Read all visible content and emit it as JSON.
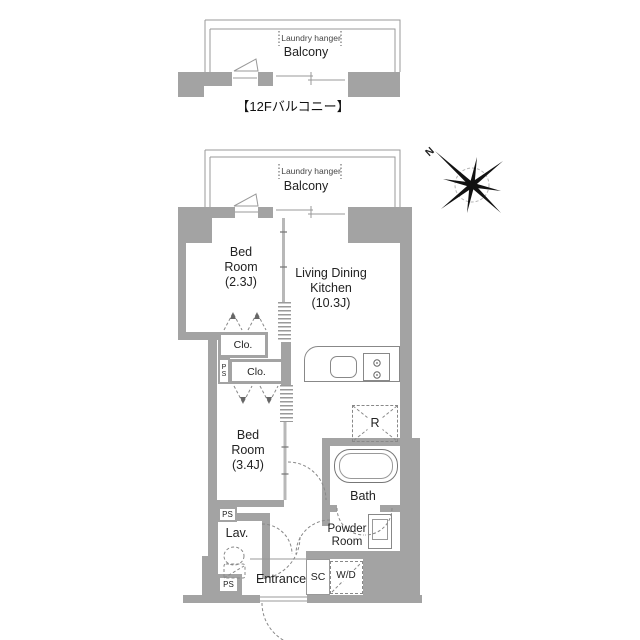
{
  "plan": {
    "upper_balcony": {
      "laundry": "Laundry hanger",
      "name": "Balcony"
    },
    "upper_caption": "【12Fバルコニー】",
    "balcony": {
      "laundry": "Laundry hanger",
      "name": "Balcony"
    },
    "rooms": {
      "bedroom1_name": "Bed Room",
      "bedroom1_size": "(2.3J)",
      "ldk_line1": "Living Dining",
      "ldk_line2": "Kitchen",
      "ldk_size": "(10.3J)",
      "bedroom2_name": "Bed Room",
      "bedroom2_size": "(3.4J)",
      "bath": "Bath",
      "powder_line1": "Powder",
      "powder_line2": "Room",
      "lavatory": "Lav.",
      "entrance": "Entrance"
    },
    "fixtures": {
      "closet1": "Clo.",
      "closet2": "Clo.",
      "ps1": "PS",
      "ps2": "PS",
      "ps3": "PS",
      "shoe_closet": "SC",
      "washer_dryer": "W/D",
      "refrigerator": "R"
    },
    "compass_north": "N",
    "colors": {
      "wall": "#a3a3a3",
      "line": "#888888",
      "text": "#222222"
    }
  }
}
